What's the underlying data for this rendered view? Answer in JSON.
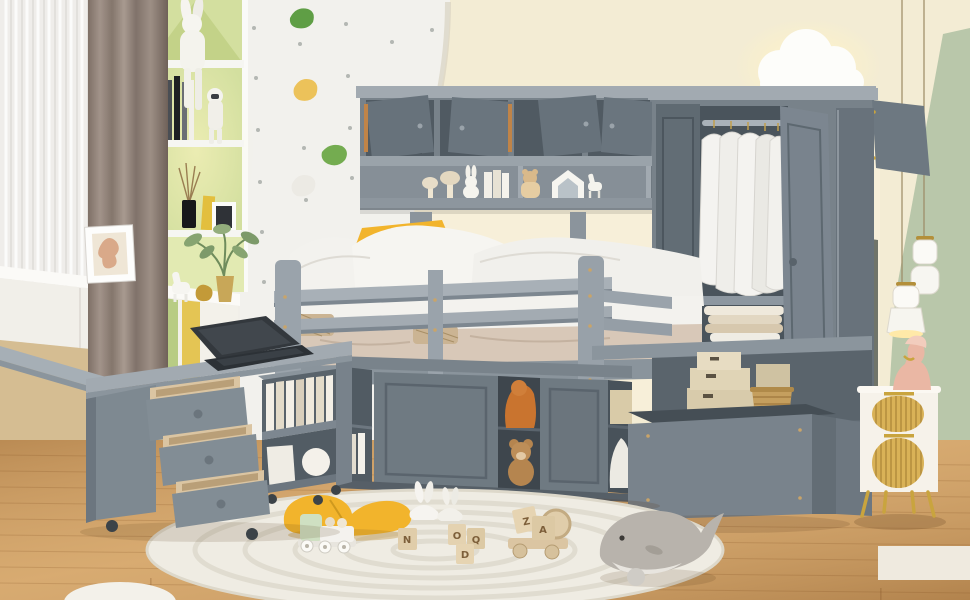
{
  "scene": {
    "type": "product-photo",
    "subject": "kids bedroom with gray loft bed storage system",
    "room": {
      "walls": [
        "white climbing wall",
        "cream arched wall",
        "sage green side wall",
        "dark olive accent panel",
        "tan under-counter wall"
      ],
      "floor": "light oak plank floor",
      "lighting": [
        "cloud wall lamp",
        "two white pendant lamps",
        "warm shelf glow"
      ]
    }
  },
  "colors": {
    "wall_cream": "#f3ecd4",
    "wall_cream_lit": "#f8f0d9",
    "wall_white": "#f2f1ed",
    "wall_sage": "#b9c7aa",
    "wall_olive": "#70746a",
    "tan_wall": "#d5bd92",
    "floor_base": "#cfa065",
    "rug": "#efece3",
    "furniture_gray": "#78828a",
    "furniture_light": "#a2aab1",
    "furniture_dark": "#505a62",
    "door_gray": "#6f7a82",
    "curtain_brown": "#93847b",
    "curtain_sheer": "#efedea",
    "shelf_green": "#d3df9f",
    "pillow_yellow": "#f2b42c",
    "bedding_white": "#f3f2ee",
    "blanket_beige": "#d8c8b8",
    "wood_toy": "#dbc5a2",
    "basket": "#c59f5e",
    "gold": "#c9a43e",
    "bust_pink": "#eab7a4",
    "whale_gray": "#b8b3ac",
    "train_mint": "#cfe0c2",
    "box_beige": "#d8cbab",
    "laptop_dark": "#33383d",
    "nightstand_white": "#f6f2ea"
  },
  "objects": {
    "left_zone": {
      "window": "sheer white curtain",
      "curtain": "brown blackout curtain",
      "house_shelf": {
        "style": "house-shaped green niche shelf",
        "items": [
          "white bunny plush",
          "books",
          "astronaut figure",
          "reed diffuser",
          "yellow book",
          "photo frame",
          "green plant in gold vase"
        ]
      },
      "counter": {
        "items": [
          "leaning art print",
          "white horse figurine",
          "gold figurine"
        ],
        "drawers": 2,
        "accent_doors": [
          "green",
          "yellow"
        ]
      },
      "climbing_wall": {
        "holds": [
          "green",
          "yellow",
          "white",
          "green",
          "green"
        ],
        "pattern": "screw dots"
      }
    },
    "loft_bed": {
      "bridge_cabinets": {
        "open_doors": 4,
        "toy_shelf_items": [
          "mushroom figurines",
          "bunny figure",
          "books",
          "bear plush",
          "house frame",
          "horse figure",
          "wooden plane"
        ]
      },
      "bed": {
        "pillows_white": 3,
        "pillow_yellow": 1,
        "blanket": "beige",
        "guard_rail_slats": 2,
        "rattan_accents": 2
      },
      "under_bed_cabinet": {
        "sliding_doors": 2,
        "contents": [
          "orange plush",
          "teddy bear",
          "beige box",
          "white plush",
          "books"
        ]
      },
      "staircase": {
        "storage_boxes": 4,
        "wicker_basket": 1
      }
    },
    "wardrobe": {
      "open_doors": 2,
      "hanging_shirts": 5,
      "folded_stack": true,
      "pillows_stored": 2,
      "top_door_open": true
    },
    "desk": {
      "shape": "L-shaped swivel",
      "open_drawers": 3,
      "laptop": true,
      "bookshelf_cart": true,
      "casters": true
    },
    "right_zone": {
      "nightstand": {
        "finish": "white with gold fluted arch doors",
        "legs": "gold"
      },
      "bust_sculpture": "pink female bust",
      "pendant_lamps": 2,
      "cloud_lamp": 1
    },
    "floor_items": {
      "rug": "round ivory braided rug",
      "yellow_pillow": 1,
      "toy_train": "mint and white with peg figures",
      "bunny_toys": 2,
      "letter_blocks": true,
      "block_truck": "wooden truck with letter blocks",
      "whale_plush": "gray whale",
      "white_pouf": "partial, bottom left"
    }
  },
  "toys": {
    "block_letters": {
      "single": "N",
      "cluster_a": "O",
      "cluster_b": "Q",
      "cluster_c": "D",
      "truck_top": "Z",
      "truck_front": "A"
    }
  }
}
